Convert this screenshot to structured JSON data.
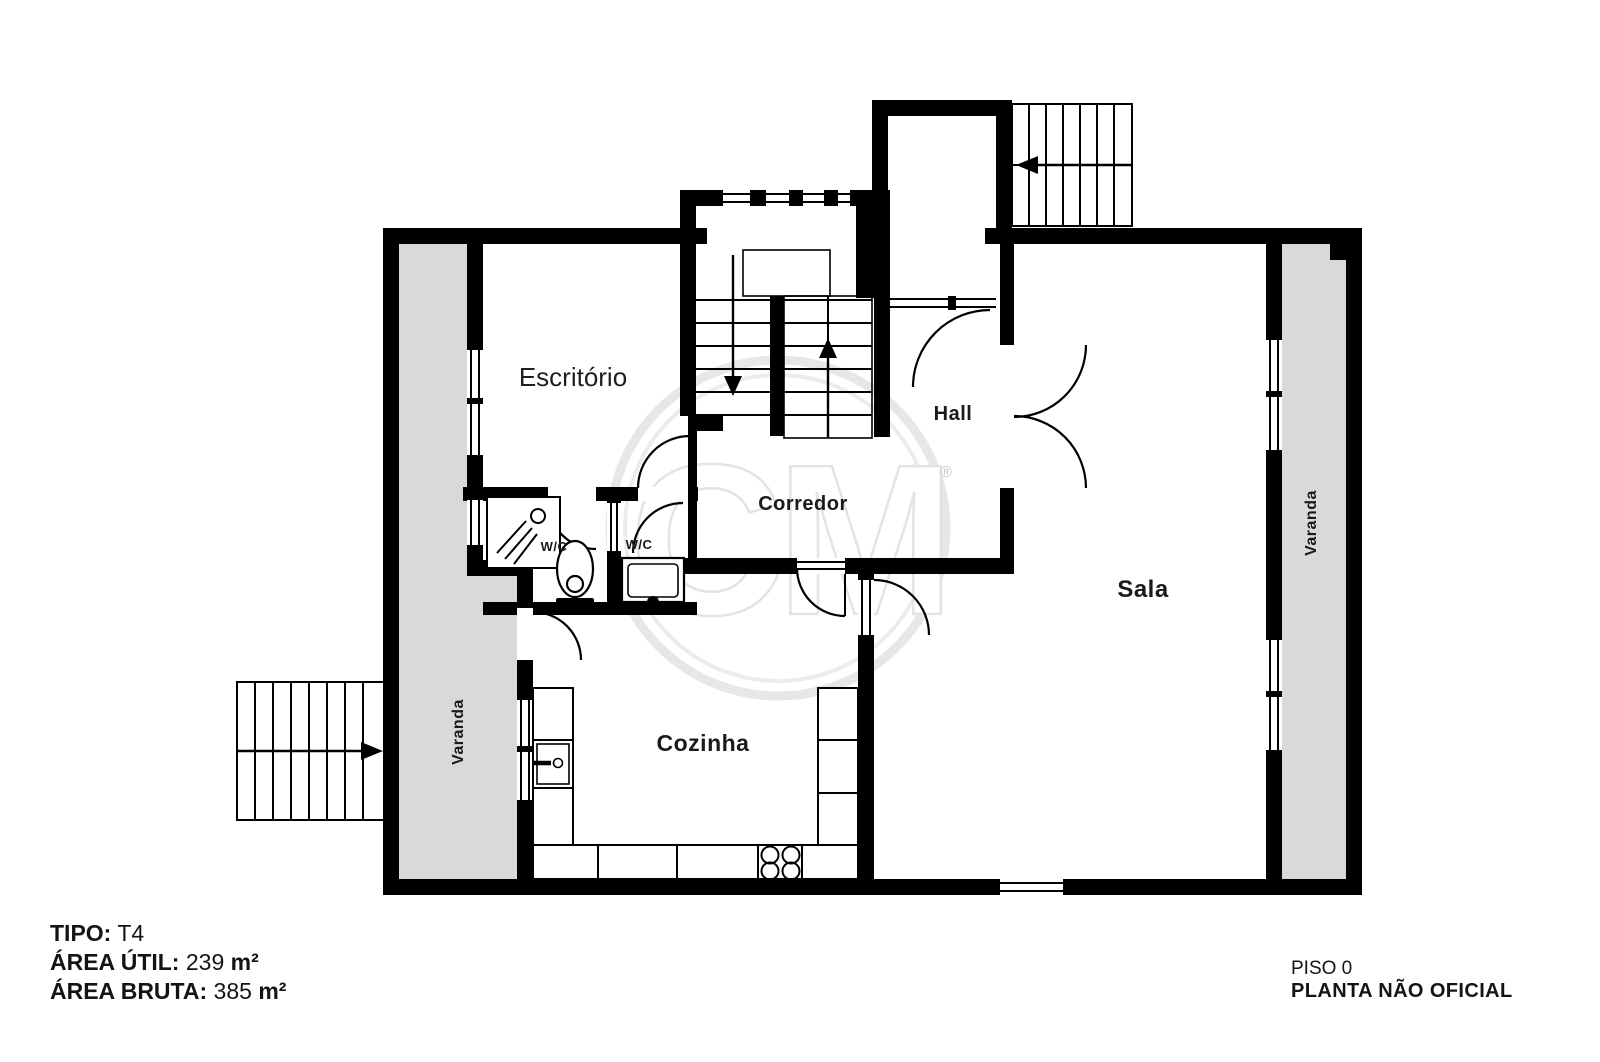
{
  "plan": {
    "labels": {
      "escritorio": "Escritório",
      "hall": "Hall",
      "corredor": "Corredor",
      "sala": "Sala",
      "cozinha": "Cozinha",
      "wc_left": "W/C",
      "wc_right": "W/C",
      "varanda_left": "Varanda",
      "varanda_right": "Varanda"
    },
    "watermark": {
      "text": "CM",
      "registered": "®"
    }
  },
  "info": {
    "tipo": {
      "label": "TIPO:",
      "value": "T4"
    },
    "area_util": {
      "label": "ÁREA ÚTIL:",
      "value": "239",
      "unit": "m²"
    },
    "area_bruta": {
      "label": "ÁREA BRUTA:",
      "value": "385",
      "unit": "m²"
    }
  },
  "footer": {
    "floor": "PISO 0",
    "disclaimer": "PLANTA NÃO OFICIAL"
  },
  "colors": {
    "wall": "#000000",
    "balcony": "#d9d9d9",
    "watermark": "#e3e3e3"
  }
}
